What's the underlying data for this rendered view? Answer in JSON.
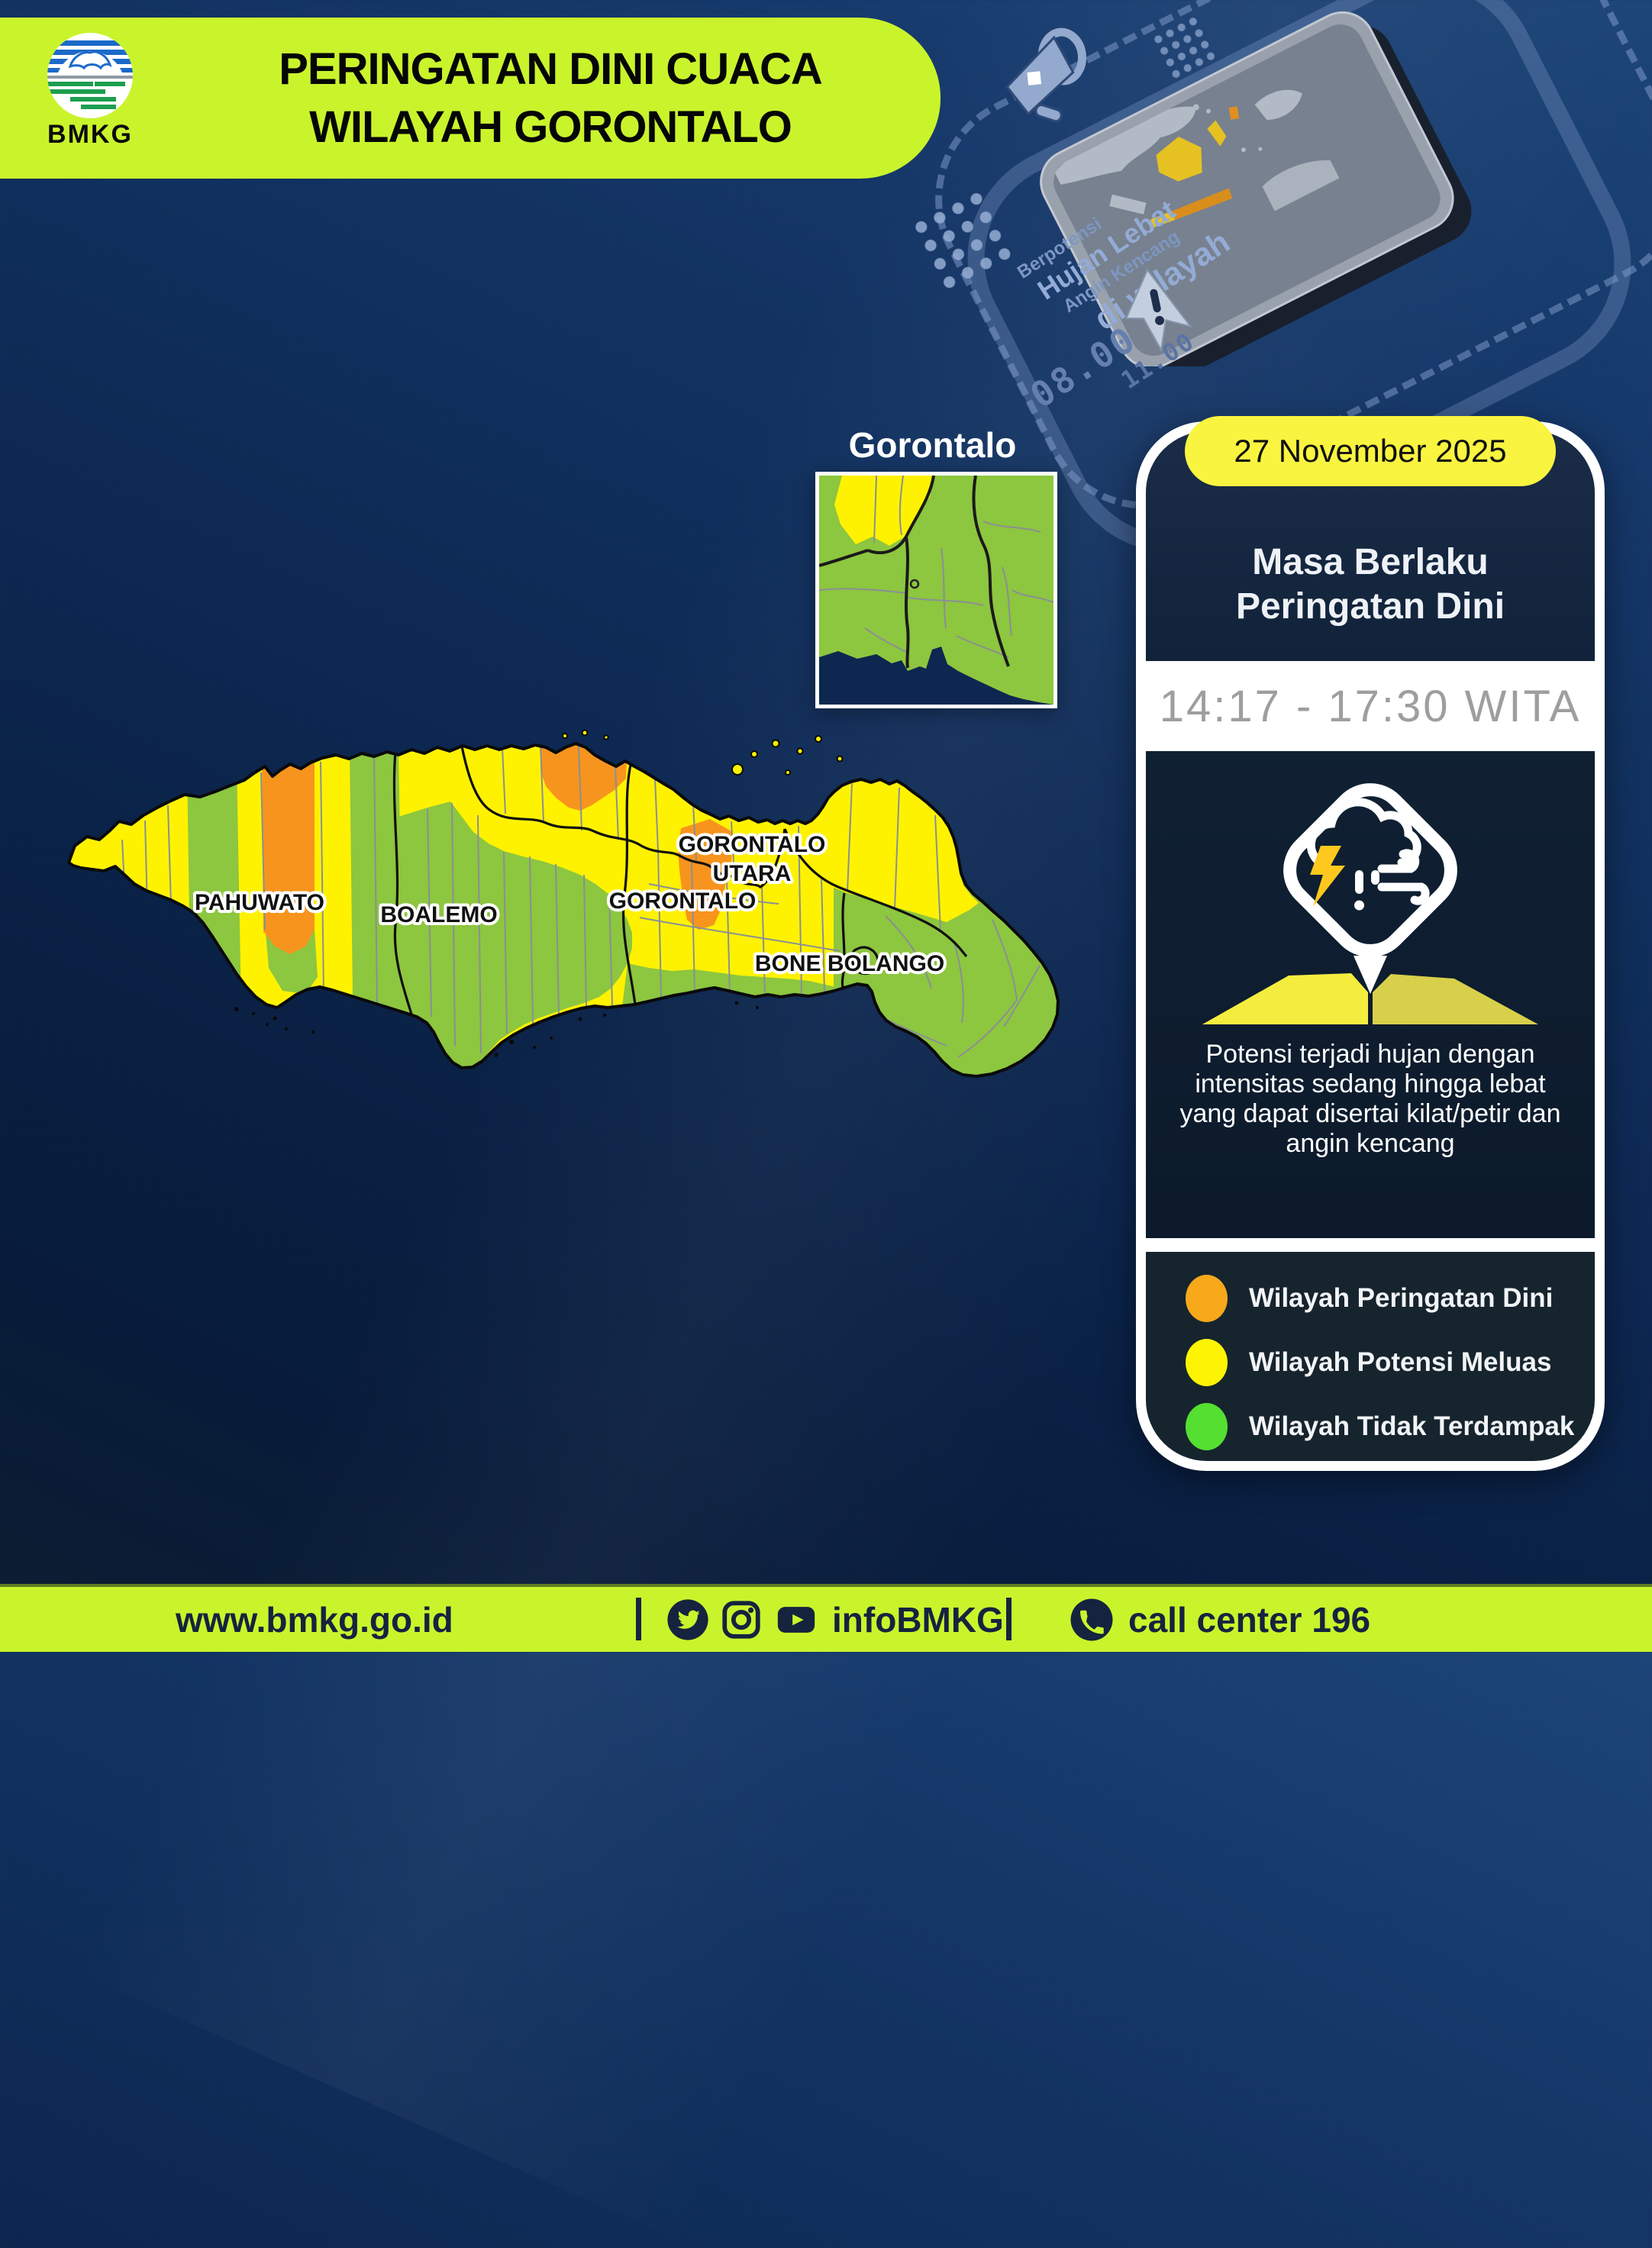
{
  "header": {
    "title_line1": "PERINGATAN DINI CUACA",
    "title_line2": "WILAYAH GORONTALO",
    "logo_label": "BMKG"
  },
  "decor": {
    "lines": [
      "Berpotensi",
      "Hujan Lebat",
      "Angin Kencang",
      "di wilayah"
    ],
    "clock_primary": "08.00",
    "clock_secondary": "11.00"
  },
  "inset": {
    "title": "Gorontalo"
  },
  "map": {
    "labels": {
      "pahuwato": "PAHUWATO",
      "boalemo": "BOALEMO",
      "gorontalo": "GORONTALO",
      "gorontalo_utara_line1": "GORONTALO",
      "gorontalo_utara_line2": "UTARA",
      "bone_bolango": "BONE BOLANGO"
    },
    "region_colors": {
      "warning": "#F7941E",
      "spreading_potential": "#FFF200",
      "not_affected": "#8DC63F"
    }
  },
  "card": {
    "date": "27 November 2025",
    "validity_line1": "Masa Berlaku",
    "validity_line2": "Peringatan Dini",
    "time_range": "14:17 - 17:30 WITA",
    "description": "Potensi terjadi hujan dengan intensitas sedang hingga lebat yang dapat disertai kilat/petir dan angin kencang",
    "legend": [
      {
        "label": "Wilayah Peringatan Dini",
        "color": "#F7A81B"
      },
      {
        "label": "Wilayah Potensi Meluas",
        "color": "#FCF403"
      },
      {
        "label": "Wilayah Tidak Terdampak",
        "color": "#55DF31"
      }
    ]
  },
  "footer": {
    "website": "www.bmkg.go.id",
    "social_handle": "infoBMKG",
    "call_center": "call center 196"
  }
}
